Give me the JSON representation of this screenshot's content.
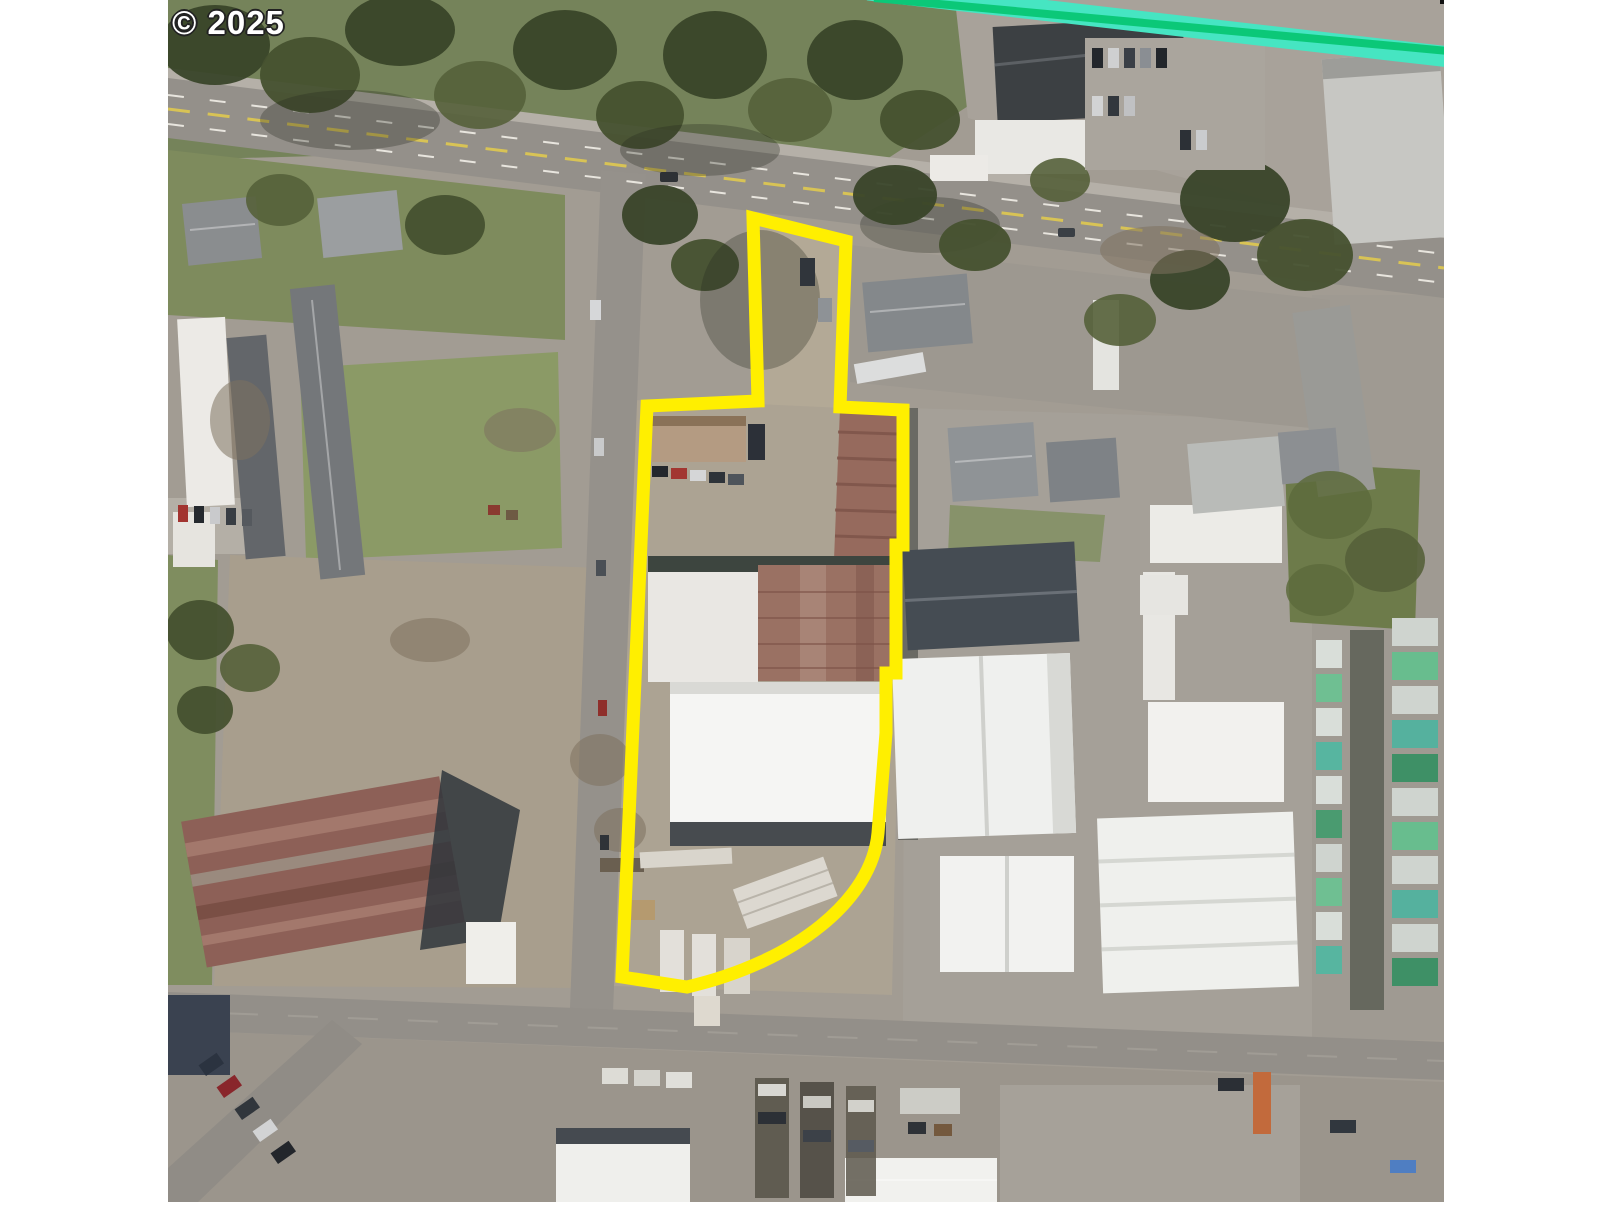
{
  "map": {
    "copyright": "© 2025",
    "colors": {
      "parcel_outline": "#ffef00",
      "plat_line_outer": "#46e5c2",
      "plat_line_inner": "#0bc878"
    },
    "parcel_outline": {
      "path": "M 753 218 L 846 241 L 840 407 L 903 410 L 903 545 L 896 545 L 896 673 L 886 673 L 886 733 L 878 833 C 872 900 795 962 687 987 L 622 977 L 647 406 L 758 401 Z",
      "stroke_width": "13"
    },
    "plat_line": {
      "outer_path": "M 868 -10 L 1450 57",
      "outer_width": "21",
      "inner_path": "M 874 -2 L 1448 51",
      "inner_width": "8"
    }
  }
}
